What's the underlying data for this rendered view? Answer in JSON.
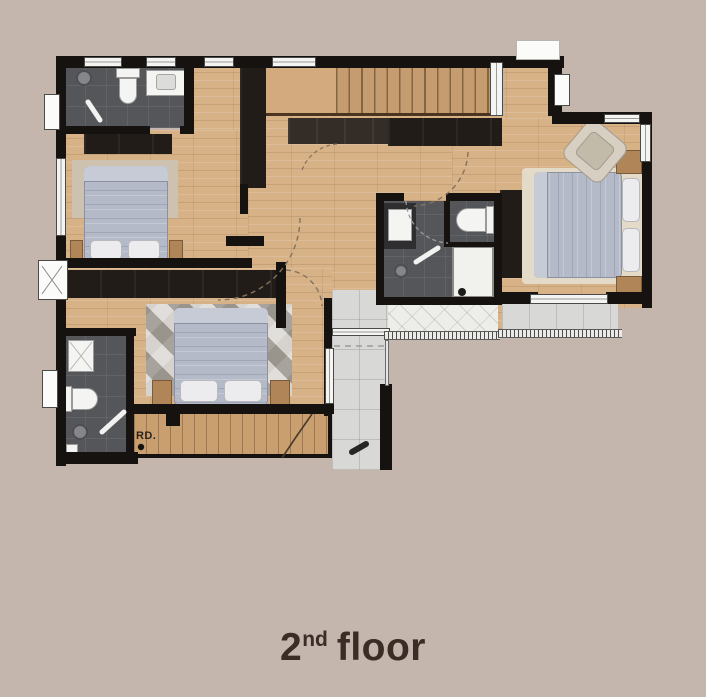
{
  "title": {
    "number": "2",
    "ordinal": "nd",
    "word": "floor"
  },
  "labels": {
    "roof_drain": "RD."
  },
  "colors": {
    "bg": "#c4b5ad",
    "wall": "#16120f",
    "wood": "#d7b287",
    "tile_dark": "#55565a",
    "tile_gray": "#d8d9d7",
    "terrazzo": "#edeee9",
    "deck": "#c99f6f",
    "stair": "#c59c6f",
    "landing": "#d2aa7e",
    "cabinet": "#211c18",
    "cabinet_light": "#332c27",
    "bed": "#b4bac8",
    "bed_fold": "#c6cbd6",
    "pillow": "#ececee",
    "rug_beige": "#cdc2b0",
    "rug_gray": "#b5afa7",
    "rug_cream": "#e4dac8",
    "tan": "#b08558",
    "fixture": "#f4f4f2",
    "title_text": "#3a2d25"
  }
}
